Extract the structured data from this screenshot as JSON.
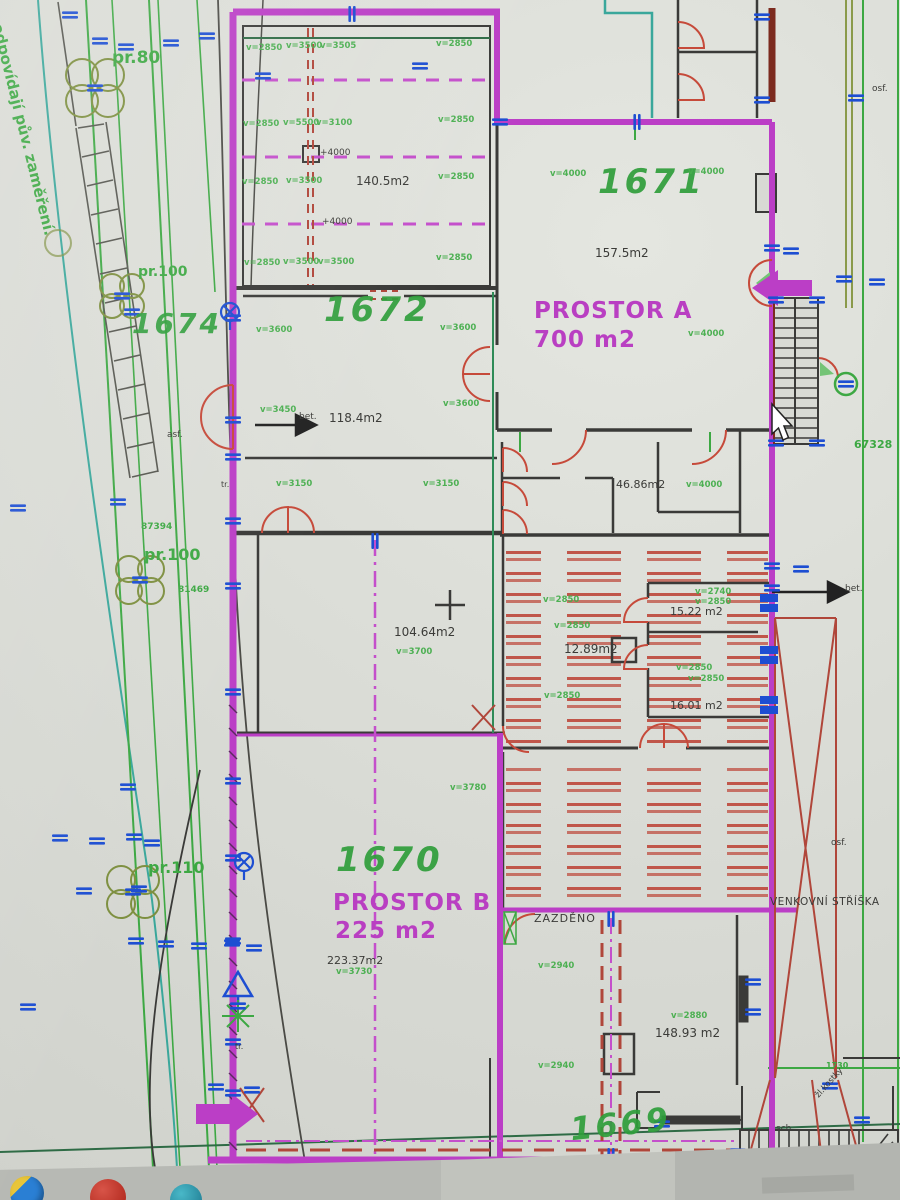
{
  "site": {
    "rotated_note": "odpovídají pův. zaměření.",
    "pr80": "pr.80",
    "pr100_upper": "pr.100",
    "parcel_1674": "1674",
    "num_87394": "87394",
    "pr100_lower": "pr.100",
    "num_81469": "81469",
    "pr110": "pr.110",
    "asf": "asf.",
    "tr_upper": "tr.",
    "tr_lower": "tr.",
    "num_67328": "67328",
    "num_1730": "1730",
    "osf_top": "osf.",
    "osf_right": "osf.",
    "bet_left": "bet.",
    "bet_right": "bet.",
    "venkovni_striska": "VENKOVNÍ STŘÍŠKA",
    "sch": "sch.",
    "kostky": "žl.kostky",
    "zazdeno": "ZAZDĚNO"
  },
  "parcels": {
    "p1671": "1671",
    "p1672": "1672",
    "p1670": "1670",
    "p1669": "1669"
  },
  "spaces": {
    "prostor_a_name": "PROSTOR A",
    "prostor_a_area": "700 m2",
    "prostor_b_name": "PROSTOR B",
    "prostor_b_area": "225 m2"
  },
  "room_areas": {
    "r140": "140.5m2",
    "r157": "157.5m2",
    "r118": "118.4m2",
    "r46": "46.86m2",
    "r104": "104.64m2",
    "r12": "12.89m2",
    "r15": "15.22 m2",
    "r16": "16.01 m2",
    "r223": "223.37m2",
    "r148": "148.93 m2"
  },
  "elevations": {
    "e1": "+4000",
    "e2": "+4000"
  },
  "dims": [
    "v=2850",
    "v=3500",
    "v=3505",
    "v=2850",
    "v=2850",
    "v=5500",
    "v=3100",
    "v=2850",
    "v=2850",
    "v=3500",
    "v=2850",
    "v=2850",
    "v=3500",
    "v=3500",
    "v=2850",
    "v=4000",
    "v=4000",
    "v=4000",
    "v=3600",
    "v=3600",
    "v=3600",
    "v=3450",
    "v=3150",
    "v=3150",
    "v=4000",
    "v=3700",
    "v=2850",
    "v=2850",
    "v=2740",
    "v=2850",
    "v=2850",
    "v=2850",
    "v=2850",
    "v=3780",
    "v=3730",
    "v=2940",
    "v=2880",
    "v=2940"
  ],
  "colors": {
    "wall_magenta": "#bb3ec6",
    "site_green": "#3da843",
    "door_red": "#c64a3a",
    "dim_blue": "#1d4ed2",
    "text_green": "#2f9e3b",
    "text_magenta": "#b93fc2",
    "ink": "#3a3a38"
  },
  "taskbar": {
    "icons": [
      {
        "name": "browser-icon"
      },
      {
        "name": "red-app-icon"
      },
      {
        "name": "teal-app-icon"
      }
    ]
  }
}
